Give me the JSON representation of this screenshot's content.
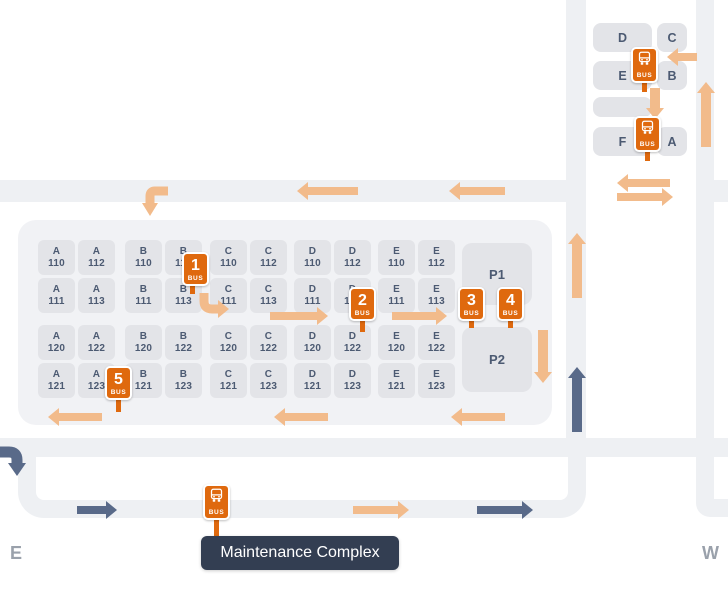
{
  "compass": {
    "east": "E",
    "west": "W"
  },
  "maintenance_badge": "Maintenance Complex",
  "stops": {
    "s1": "1",
    "s2": "2",
    "s3": "3",
    "s4": "4",
    "s5": "5",
    "bus_label": "BUS"
  },
  "parking": {
    "p1": "P1",
    "p2": "P2"
  },
  "cluster": {
    "d": "D",
    "c": "C",
    "e": "E",
    "b": "B",
    "f": "F",
    "a": "A"
  },
  "grid": {
    "groups": [
      "A",
      "B",
      "C",
      "D",
      "E"
    ],
    "suffix_rows": [
      [
        "110",
        "112"
      ],
      [
        "111",
        "113"
      ],
      [
        "120",
        "122"
      ],
      [
        "121",
        "123"
      ]
    ]
  },
  "colors": {
    "stop_orange": "#df690e",
    "route_orange": "#f2bb8b",
    "route_slate": "#596a89",
    "badge_bg": "#333e52",
    "road": "#eef0f3",
    "building": "#e3e4e8"
  }
}
